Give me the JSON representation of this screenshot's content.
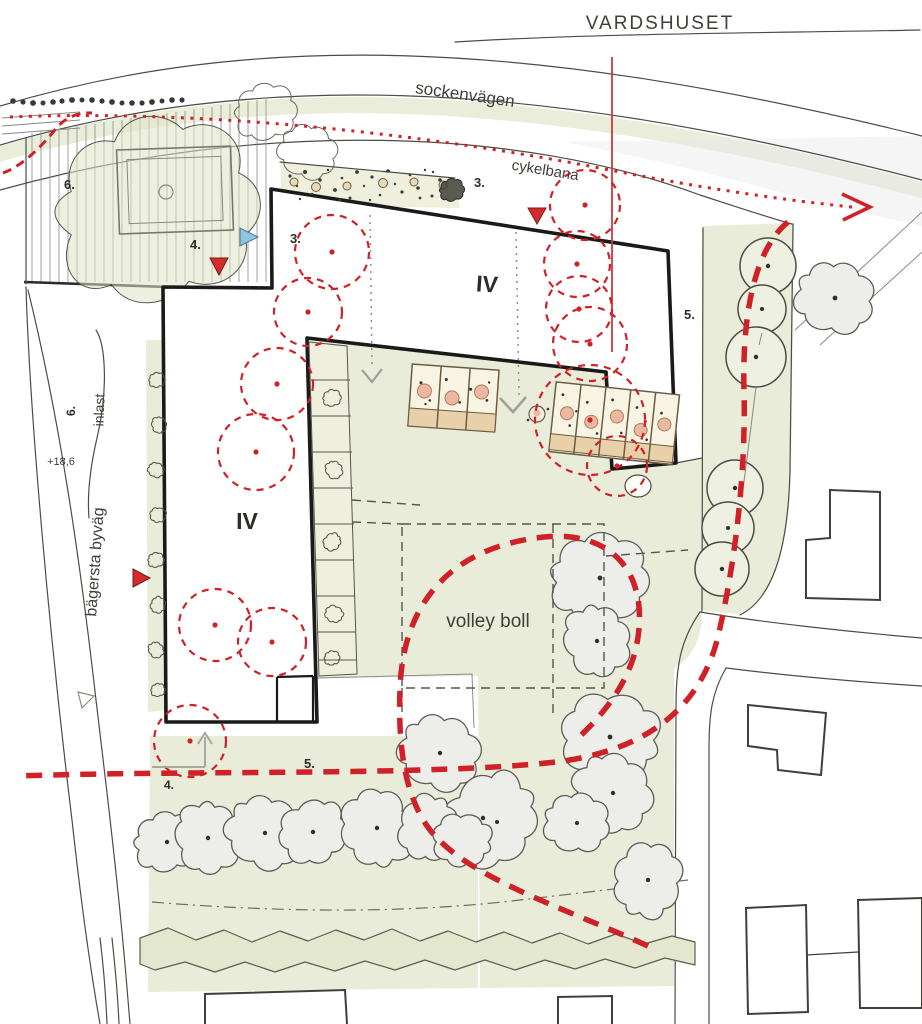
{
  "title": {
    "vardshuset": "VARDSHUSET"
  },
  "roads": {
    "top": "sockenvägen",
    "bike_path": "cykelbana",
    "left": "bägersta byväg"
  },
  "site": {
    "volleyball_label": "volley boll",
    "loading_label": "inlast",
    "spot_height": "+18,6",
    "north_wing_floors": "IV",
    "west_wing_floors": "IV"
  },
  "annotations": [
    {
      "label": "6."
    },
    {
      "label": "4."
    },
    {
      "label": "3."
    },
    {
      "label": "3."
    },
    {
      "label": "5."
    },
    {
      "label": "6."
    },
    {
      "label": "5."
    },
    {
      "label": "4."
    }
  ],
  "icons": [
    "red-triangle-marker",
    "blue-triangle-marker",
    "entry-arrow-icon",
    "cycle-route-arrow-icon"
  ],
  "colors": {
    "site_green": "#e9ecd8",
    "hedge_green": "#e3e7cd",
    "route_red": "#cf2127",
    "building_outline": "#1a1a18",
    "sketch_line": "#4c4c46",
    "bed_tan": "#e8d0a9",
    "bed_peach": "#eab9a0",
    "existing_tree_fill": "#ededea",
    "marker_blue": "#8fc6df",
    "text": "#3f3f3a"
  }
}
